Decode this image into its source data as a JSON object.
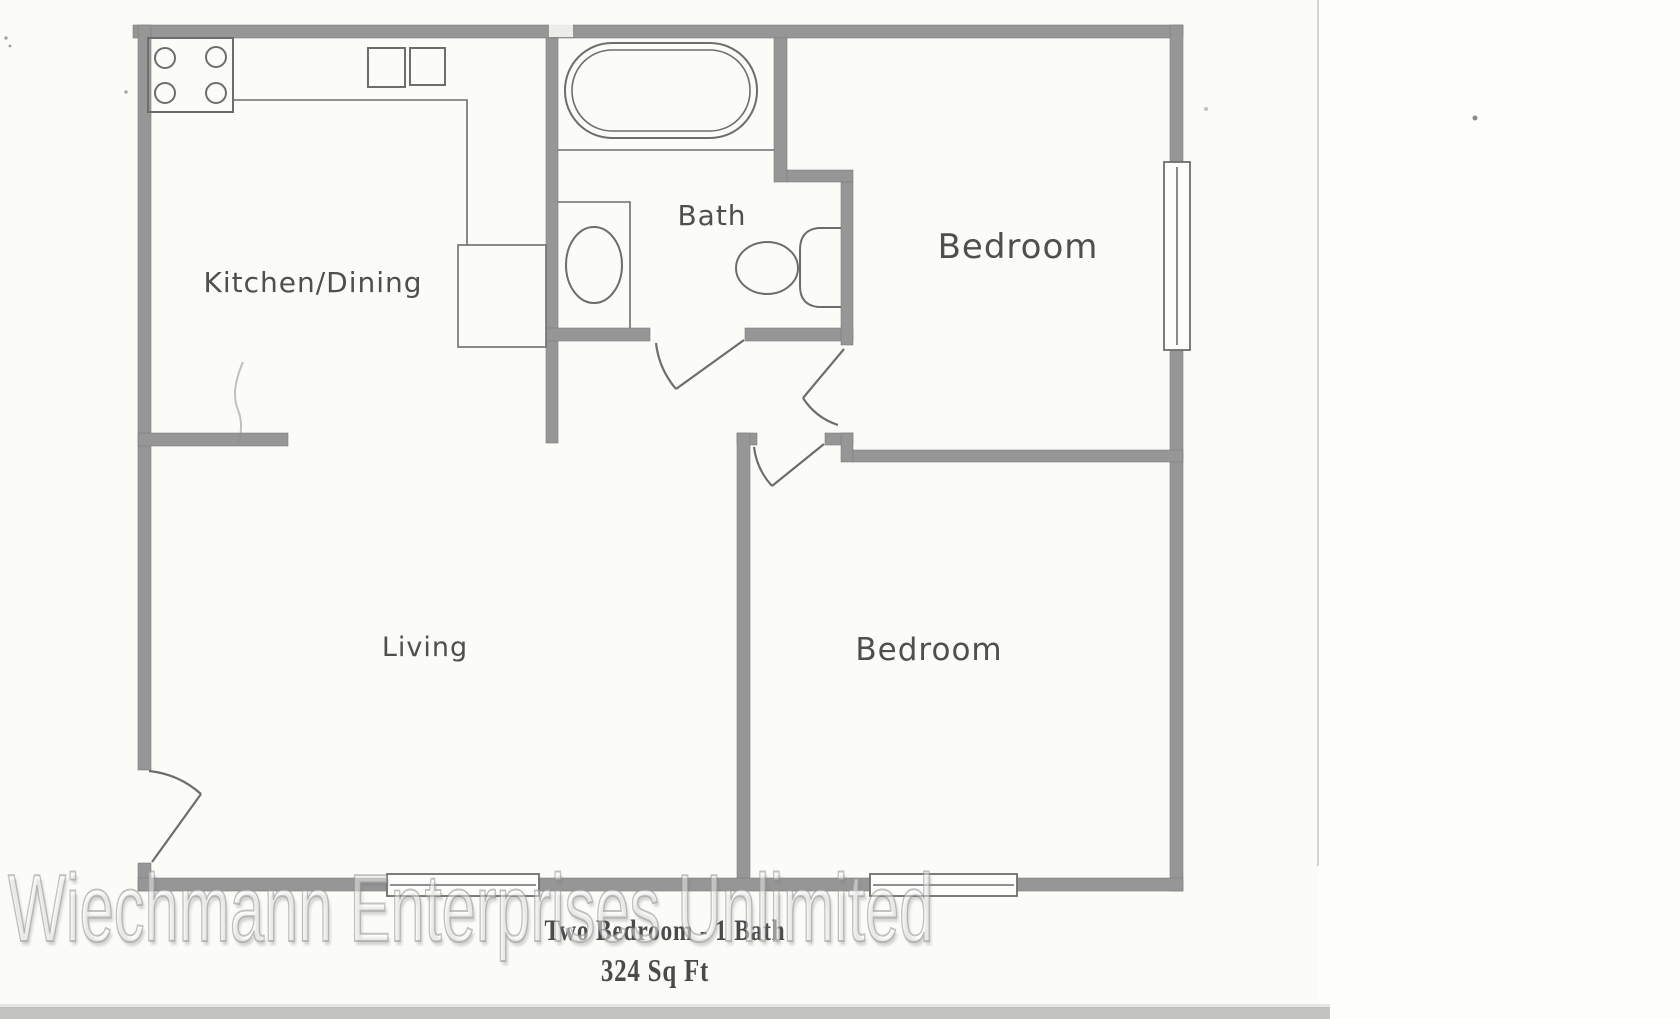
{
  "footer": {
    "title": "Two Bedroom - 1 Bath",
    "area": "324 Sq Ft"
  },
  "watermark": {
    "text": "Wiechmann Enterprises Unlimited"
  },
  "rooms": [
    {
      "label": "Kitchen/Dining"
    },
    {
      "label": "Bath"
    },
    {
      "label": "Bedroom"
    },
    {
      "label": "Living"
    },
    {
      "label": "Bedroom"
    }
  ],
  "fixtures": [
    "stove-burners-icon",
    "kitchen-double-sink-icon",
    "counter-icon",
    "pantry-box-icon",
    "bathtub-icon",
    "vanity-sink-icon",
    "toilet-icon",
    "window-icon",
    "door-swing-icon"
  ],
  "colors": {
    "wall": "#969696",
    "line": "#6d6d6d",
    "label": "#4f4f4f",
    "title_ink": "#4a4a4a",
    "page": "#fbfbf8",
    "margin": "#fdfdfb",
    "band": "#b0b0b0"
  }
}
